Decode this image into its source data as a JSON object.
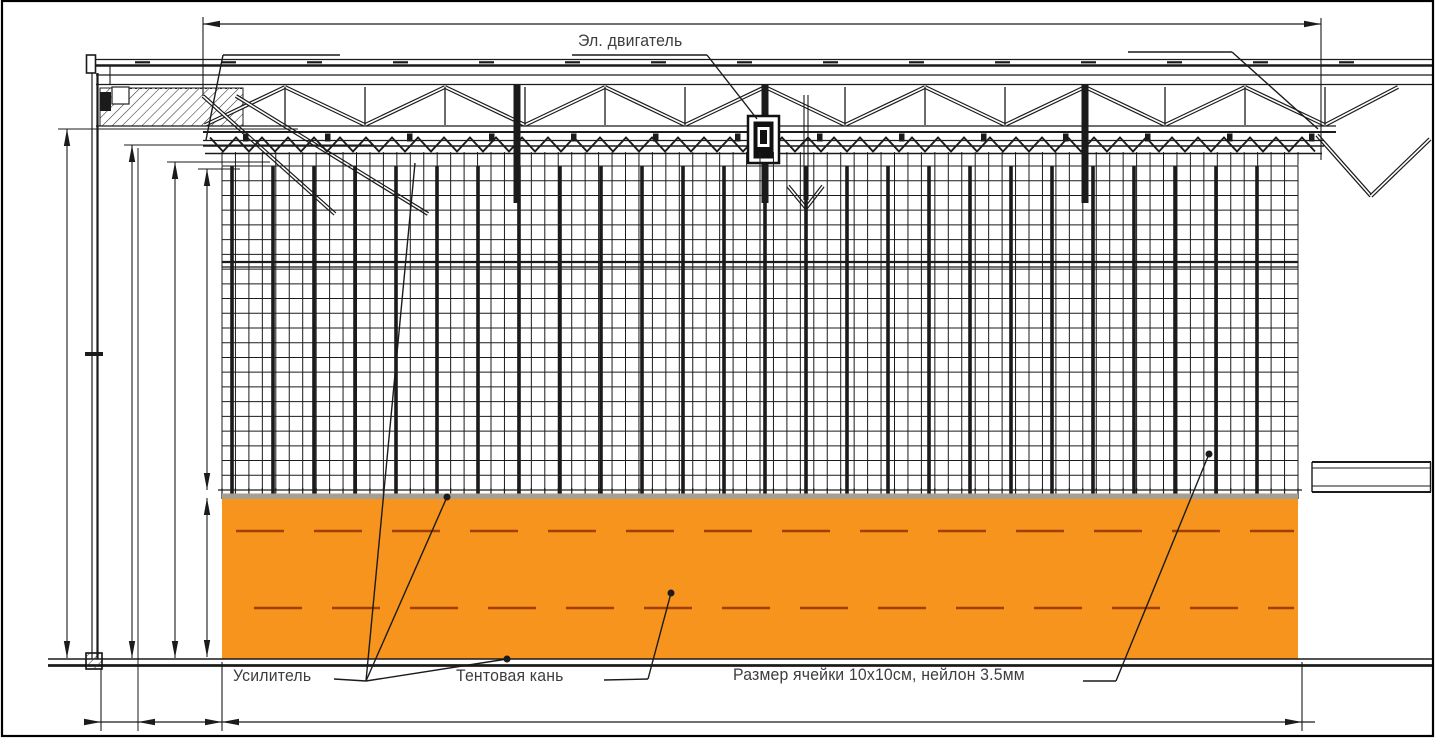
{
  "drawing": {
    "type": "technical-elevation-drawing",
    "labels": {
      "motor": "Эл. двигатель",
      "reinforcement": "Усилитель",
      "tent_fabric": "Тентовая кань",
      "mesh_spec": "Размер ячейки 10х10см,  нейлон 3.5мм"
    },
    "colors": {
      "line": "#1b1b1b",
      "text": "#3d3d3d",
      "fabric": "#F7941D",
      "fabric_dash": "#A04000",
      "fabric_top_strip": "#A59F93"
    }
  }
}
